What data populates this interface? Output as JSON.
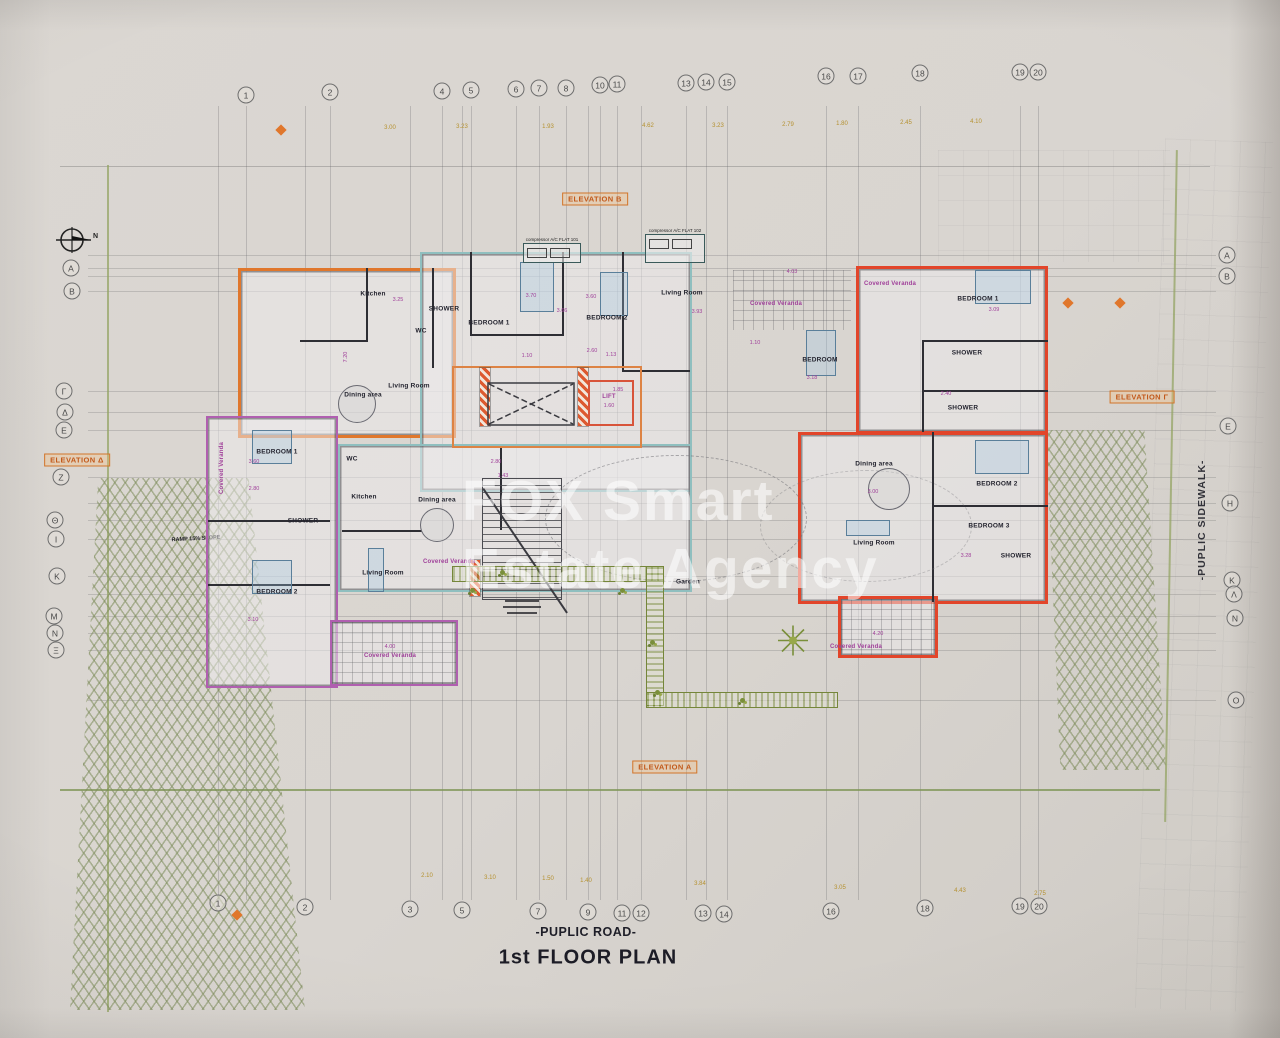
{
  "meta": {
    "title": "1st  FLOOR PLAN",
    "road": "-PUPLIC ROAD-",
    "sidewalk": "-PUPLIC SIDEWALK-"
  },
  "watermark": {
    "line1": "FOX Smart",
    "line2": "Estate Agency"
  },
  "colors": {
    "paper": "#d9d5d0",
    "flat_orange": "#e0772c",
    "flat_red": "#e2452a",
    "flat_teal": "#8fbfbf",
    "flat_purple": "#b05fb0",
    "dim_olive": "#b5912f",
    "dim_magenta": "#a0409a",
    "boundary_green": "#94a464",
    "badge_orange": "#c2591a"
  },
  "ramp": {
    "label": "RAMP 15% SLOPE"
  },
  "lift": {
    "label": "LIFT"
  },
  "garden": {
    "label": "Garden"
  },
  "elevations": [
    {
      "label": "ELEVATION B",
      "x": 595,
      "y": 199
    },
    {
      "label": "ELEVATION A",
      "x": 665,
      "y": 767
    },
    {
      "label": "ELEVATION Γ",
      "x": 1142,
      "y": 397
    },
    {
      "label": "ELEVATION Δ",
      "x": 77,
      "y": 460
    }
  ],
  "grid_top": [
    {
      "label": "1",
      "x": 246,
      "y": 95
    },
    {
      "label": "2",
      "x": 330,
      "y": 92
    },
    {
      "label": "4",
      "x": 442,
      "y": 91
    },
    {
      "label": "5",
      "x": 471,
      "y": 90
    },
    {
      "label": "6",
      "x": 516,
      "y": 89
    },
    {
      "label": "7",
      "x": 539,
      "y": 88
    },
    {
      "label": "8",
      "x": 566,
      "y": 88
    },
    {
      "label": "10",
      "x": 600,
      "y": 85
    },
    {
      "label": "11",
      "x": 617,
      "y": 84
    },
    {
      "label": "13",
      "x": 686,
      "y": 83
    },
    {
      "label": "14",
      "x": 706,
      "y": 82
    },
    {
      "label": "15",
      "x": 727,
      "y": 82
    },
    {
      "label": "16",
      "x": 826,
      "y": 76
    },
    {
      "label": "17",
      "x": 858,
      "y": 76
    },
    {
      "label": "18",
      "x": 920,
      "y": 73
    },
    {
      "label": "19",
      "x": 1020,
      "y": 72
    },
    {
      "label": "20",
      "x": 1038,
      "y": 72
    }
  ],
  "grid_bottom": [
    {
      "label": "1",
      "x": 218,
      "y": 903
    },
    {
      "label": "2",
      "x": 305,
      "y": 907
    },
    {
      "label": "3",
      "x": 410,
      "y": 909
    },
    {
      "label": "5",
      "x": 462,
      "y": 910
    },
    {
      "label": "7",
      "x": 538,
      "y": 911
    },
    {
      "label": "9",
      "x": 588,
      "y": 912
    },
    {
      "label": "11",
      "x": 622,
      "y": 913
    },
    {
      "label": "12",
      "x": 641,
      "y": 913
    },
    {
      "label": "13",
      "x": 703,
      "y": 913
    },
    {
      "label": "14",
      "x": 724,
      "y": 914
    },
    {
      "label": "16",
      "x": 831,
      "y": 911
    },
    {
      "label": "18",
      "x": 925,
      "y": 908
    },
    {
      "label": "19",
      "x": 1020,
      "y": 906
    },
    {
      "label": "20",
      "x": 1039,
      "y": 906
    }
  ],
  "grid_left": [
    {
      "label": "A",
      "x": 71,
      "y": 268
    },
    {
      "label": "B",
      "x": 72,
      "y": 291
    },
    {
      "label": "Γ",
      "x": 64,
      "y": 391
    },
    {
      "label": "Δ",
      "x": 65,
      "y": 412
    },
    {
      "label": "E",
      "x": 64,
      "y": 430
    },
    {
      "label": "Z",
      "x": 61,
      "y": 477
    },
    {
      "label": "Θ",
      "x": 55,
      "y": 520
    },
    {
      "label": "I",
      "x": 56,
      "y": 539
    },
    {
      "label": "K",
      "x": 57,
      "y": 576
    },
    {
      "label": "M",
      "x": 54,
      "y": 616
    },
    {
      "label": "N",
      "x": 55,
      "y": 633
    },
    {
      "label": "Ξ",
      "x": 56,
      "y": 650
    }
  ],
  "grid_right": [
    {
      "label": "A",
      "x": 1227,
      "y": 255
    },
    {
      "label": "B",
      "x": 1227,
      "y": 276
    },
    {
      "label": "E",
      "x": 1228,
      "y": 426
    },
    {
      "label": "H",
      "x": 1230,
      "y": 503
    },
    {
      "label": "K",
      "x": 1232,
      "y": 580
    },
    {
      "label": "Λ",
      "x": 1234,
      "y": 594
    },
    {
      "label": "N",
      "x": 1235,
      "y": 618
    },
    {
      "label": "O",
      "x": 1236,
      "y": 700
    }
  ],
  "dims_top": [
    {
      "t": "3.00",
      "x": 390,
      "y": 128
    },
    {
      "t": "3.23",
      "x": 462,
      "y": 127
    },
    {
      "t": "1.93",
      "x": 548,
      "y": 127
    },
    {
      "t": "4.62",
      "x": 648,
      "y": 126
    },
    {
      "t": "3.23",
      "x": 718,
      "y": 126
    },
    {
      "t": "2.79",
      "x": 788,
      "y": 125
    },
    {
      "t": "1.80",
      "x": 842,
      "y": 124
    },
    {
      "t": "2.45",
      "x": 906,
      "y": 123
    },
    {
      "t": "4.10",
      "x": 976,
      "y": 122
    }
  ],
  "dims_bottom": [
    {
      "t": "2.10",
      "x": 427,
      "y": 876
    },
    {
      "t": "3.10",
      "x": 490,
      "y": 878
    },
    {
      "t": "1.50",
      "x": 548,
      "y": 879
    },
    {
      "t": "1.40",
      "x": 586,
      "y": 881
    },
    {
      "t": "3.84",
      "x": 700,
      "y": 884
    },
    {
      "t": "3.05",
      "x": 840,
      "y": 888
    },
    {
      "t": "4.43",
      "x": 960,
      "y": 891
    },
    {
      "t": "2.75",
      "x": 1040,
      "y": 894
    }
  ],
  "dims_small": [
    {
      "t": "7.20",
      "x": 346,
      "y": 357,
      "cls": "vert"
    },
    {
      "t": "3.25",
      "x": 398,
      "y": 300
    },
    {
      "t": "3.70",
      "x": 531,
      "y": 296
    },
    {
      "t": "3.66",
      "x": 562,
      "y": 311
    },
    {
      "t": "3.60",
      "x": 591,
      "y": 297
    },
    {
      "t": "2.60",
      "x": 592,
      "y": 351
    },
    {
      "t": "1.10",
      "x": 527,
      "y": 356
    },
    {
      "t": "4.03",
      "x": 792,
      "y": 272
    },
    {
      "t": "3.93",
      "x": 697,
      "y": 312
    },
    {
      "t": "1.10",
      "x": 755,
      "y": 343
    },
    {
      "t": "3.18",
      "x": 812,
      "y": 378
    },
    {
      "t": "4.20",
      "x": 878,
      "y": 634
    },
    {
      "t": "4.00",
      "x": 390,
      "y": 647
    },
    {
      "t": "1.85",
      "x": 618,
      "y": 390
    },
    {
      "t": "1.60",
      "x": 609,
      "y": 406
    },
    {
      "t": "3.09",
      "x": 994,
      "y": 310
    },
    {
      "t": "2.40",
      "x": 946,
      "y": 394
    },
    {
      "t": "3.00",
      "x": 873,
      "y": 492
    },
    {
      "t": "3.28",
      "x": 966,
      "y": 556
    },
    {
      "t": "2.80",
      "x": 254,
      "y": 489
    },
    {
      "t": "3.60",
      "x": 254,
      "y": 462
    },
    {
      "t": "3.10",
      "x": 253,
      "y": 620
    },
    {
      "t": "1.43",
      "x": 503,
      "y": 476
    },
    {
      "t": "2.80",
      "x": 496,
      "y": 462
    },
    {
      "t": "1.13",
      "x": 611,
      "y": 355
    }
  ],
  "rooms": [
    {
      "t": "Kitchen",
      "x": 373,
      "y": 294
    },
    {
      "t": "SHOWER",
      "x": 444,
      "y": 309
    },
    {
      "t": "BEDROOM 1",
      "x": 489,
      "y": 323
    },
    {
      "t": "WC",
      "x": 421,
      "y": 331
    },
    {
      "t": "BEDROOM 2",
      "x": 607,
      "y": 318
    },
    {
      "t": "Living Room",
      "x": 409,
      "y": 386
    },
    {
      "t": "Dining area",
      "x": 363,
      "y": 395
    },
    {
      "t": "LIFT",
      "x": 609,
      "y": 397,
      "cls": "m"
    },
    {
      "t": "Living Room",
      "x": 682,
      "y": 293
    },
    {
      "t": "Covered Veranda",
      "x": 776,
      "y": 304,
      "cls": "m"
    },
    {
      "t": "BEDROOM",
      "x": 820,
      "y": 360
    },
    {
      "t": "Covered Veranda",
      "x": 890,
      "y": 284,
      "cls": "m"
    },
    {
      "t": "BEDROOM 1",
      "x": 978,
      "y": 299
    },
    {
      "t": "SHOWER",
      "x": 967,
      "y": 353
    },
    {
      "t": "SHOWER",
      "x": 963,
      "y": 408
    },
    {
      "t": "Dining area",
      "x": 874,
      "y": 464
    },
    {
      "t": "Living Room",
      "x": 874,
      "y": 543
    },
    {
      "t": "BEDROOM 2",
      "x": 997,
      "y": 484
    },
    {
      "t": "BEDROOM 3",
      "x": 989,
      "y": 526
    },
    {
      "t": "SHOWER",
      "x": 1016,
      "y": 556
    },
    {
      "t": "Covered Veranda",
      "x": 856,
      "y": 647,
      "cls": "m"
    },
    {
      "t": "WC",
      "x": 352,
      "y": 459
    },
    {
      "t": "Kitchen",
      "x": 364,
      "y": 497
    },
    {
      "t": "Dining area",
      "x": 437,
      "y": 500
    },
    {
      "t": "Living Room",
      "x": 383,
      "y": 573
    },
    {
      "t": "Covered Veranda",
      "x": 449,
      "y": 562,
      "cls": "m"
    },
    {
      "t": "BEDROOM 1",
      "x": 277,
      "y": 452
    },
    {
      "t": "SHOWER",
      "x": 303,
      "y": 521
    },
    {
      "t": "BEDROOM 2",
      "x": 277,
      "y": 592
    },
    {
      "t": "Covered Veranda",
      "x": 390,
      "y": 656,
      "cls": "m"
    },
    {
      "t": "Covered Veranda",
      "x": 222,
      "y": 468,
      "cls": "m vert"
    },
    {
      "t": "Garden",
      "x": 688,
      "y": 582
    }
  ],
  "ac_units": [
    {
      "label": "compressor A/C FLAT 101",
      "x": 523,
      "y": 243,
      "w": 58,
      "h": 20
    },
    {
      "label": "compressor A/C FLAT 102",
      "x": 645,
      "y": 234,
      "w": 60,
      "h": 29
    }
  ],
  "markers": [
    {
      "x": 281,
      "y": 130
    },
    {
      "x": 237,
      "y": 915
    },
    {
      "x": 1068,
      "y": 303
    },
    {
      "x": 1120,
      "y": 303
    }
  ]
}
